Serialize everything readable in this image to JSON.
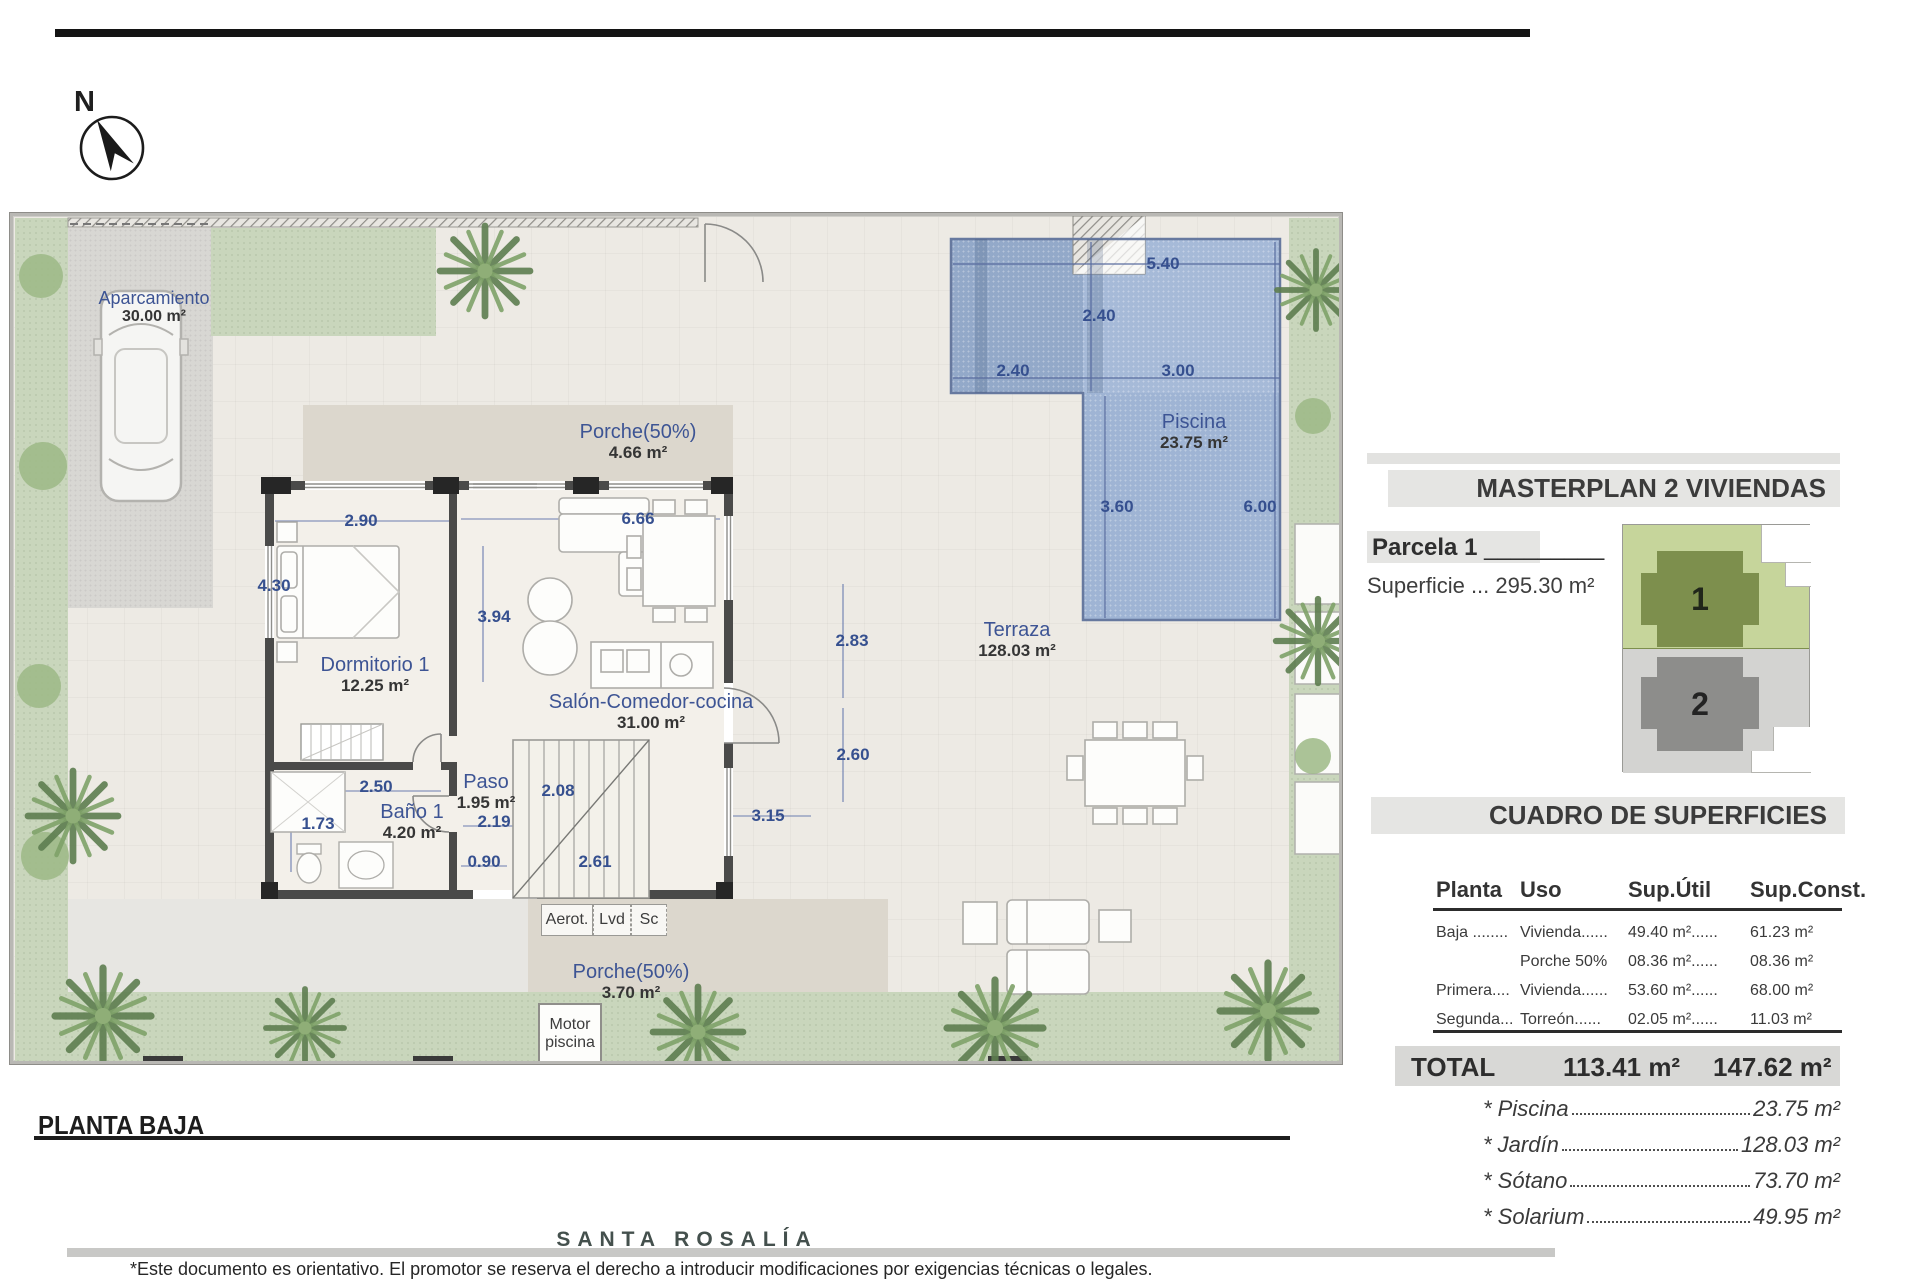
{
  "header": {
    "north_label": "N"
  },
  "plan": {
    "title": "PLANTA BAJA",
    "labels": {
      "aparcamiento": {
        "name": "Aparcamiento",
        "value": "30.00 m²"
      },
      "porche_top": {
        "name": "Porche(50%)",
        "value": "4.66 m²"
      },
      "dormitorio": {
        "name": "Dormitorio 1",
        "value": "12.25 m²"
      },
      "salon": {
        "name": "Salón-Comedor-cocina",
        "value": "31.00 m²"
      },
      "paso": {
        "name": "Paso",
        "value": "1.95 m²"
      },
      "bano": {
        "name": "Baño 1",
        "value": "4.20 m²"
      },
      "terraza": {
        "name": "Terraza",
        "value": "128.03 m²"
      },
      "piscina": {
        "name": "Piscina",
        "value": "23.75 m²"
      },
      "porche_bottom": {
        "name": "Porche(50%)",
        "value": "3.70 m²"
      },
      "motor": {
        "line1": "Motor",
        "line2": "piscina"
      },
      "aerot": "Aerot.",
      "lvd": "Lvd",
      "sc": "Sc"
    },
    "dims": [
      "2.90",
      "6.66",
      "4.30",
      "3.94",
      "2.83",
      "2.60",
      "2.50",
      "2.08",
      "3.15",
      "2.19",
      "1.73",
      "0.90",
      "2.61",
      "5.40",
      "2.40",
      "2.40",
      "3.00",
      "3.60",
      "6.00"
    ]
  },
  "panel": {
    "masterplan_title": "MASTERPLAN 2 VIVIENDAS",
    "parcela_label": "Parcela 1",
    "parcela_line": " _________",
    "superficie": "Superficie ... 295.30 m²",
    "minimap": {
      "unit1": "1",
      "unit2": "2"
    },
    "cuadro_title": "CUADRO DE SUPERFICIES",
    "table": {
      "headers": [
        "Planta",
        "Uso",
        "Sup.Útil",
        "Sup.Const."
      ],
      "rows": [
        [
          "Baja ........",
          "Vivienda......",
          "49.40 m²......",
          "61.23 m²"
        ],
        [
          "",
          "Porche 50%",
          "08.36 m²......",
          "08.36 m²"
        ],
        [
          "Primera....",
          "Vivienda......",
          "53.60 m²......",
          "68.00 m²"
        ],
        [
          "Segunda...",
          "Torreón......",
          "02.05 m²......",
          "11.03 m²"
        ]
      ],
      "total_label": "TOTAL",
      "total_util": "113.41 m²",
      "total_const": "147.62 m²"
    },
    "extras": [
      {
        "label": "* Piscina",
        "value": "23.75 m²"
      },
      {
        "label": "* Jardín",
        "value": "128.03 m²"
      },
      {
        "label": "* Sótano",
        "value": "73.70 m²"
      },
      {
        "label": "* Solarium",
        "value": "49.95 m²"
      }
    ]
  },
  "footer": {
    "brand": "SANTA ROSALÍA",
    "disclaimer": "*Este documento es orientativo. El promotor se reserva el derecho a introducir modificaciones por exigencias técnicas o legales."
  },
  "colors": {
    "accent_blue": "#3d5494",
    "pool": "#a6bad8",
    "grass": "#c9d6bc",
    "wall": "#4a4a49"
  }
}
